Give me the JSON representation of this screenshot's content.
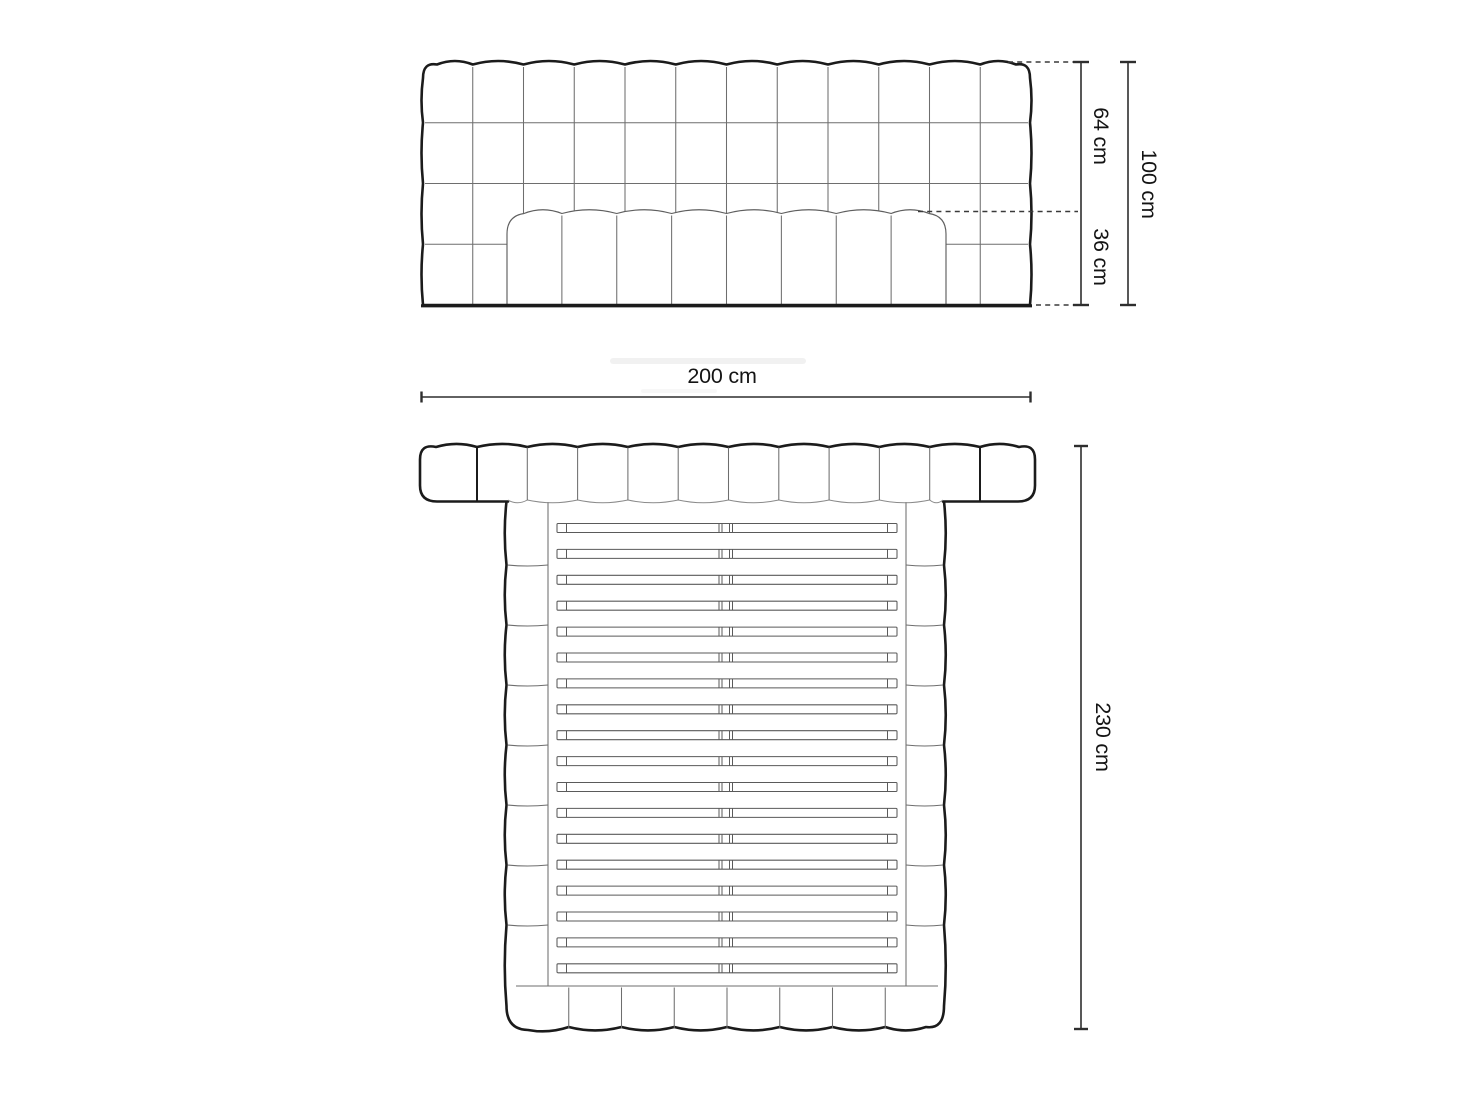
{
  "drawing": {
    "views": {
      "front": {
        "headboard_columns": 12,
        "headboard_rows": 4,
        "mattress_channels": 8
      },
      "top": {
        "headboard_segments": 12,
        "side_segments_per_rail": 8,
        "footer_segments": 8,
        "slat_count": 18
      }
    },
    "dimensions": {
      "headboard_upper": {
        "label": "64 cm",
        "value": 64,
        "unit": "cm"
      },
      "mattress_height": {
        "label": "36 cm",
        "value": 36,
        "unit": "cm"
      },
      "total_height": {
        "label": "100 cm",
        "value": 100,
        "unit": "cm"
      },
      "width": {
        "label": "200 cm",
        "value": 200,
        "unit": "cm"
      },
      "length": {
        "label": "230 cm",
        "value": 230,
        "unit": "cm"
      }
    },
    "colors": {
      "background": "#ffffff",
      "outline": "#1b1b1b",
      "panel_line": "#6e6e6e",
      "slat_line": "#5a5a5a",
      "dimension_line": "#2e2e2e",
      "text": "#141414"
    }
  }
}
